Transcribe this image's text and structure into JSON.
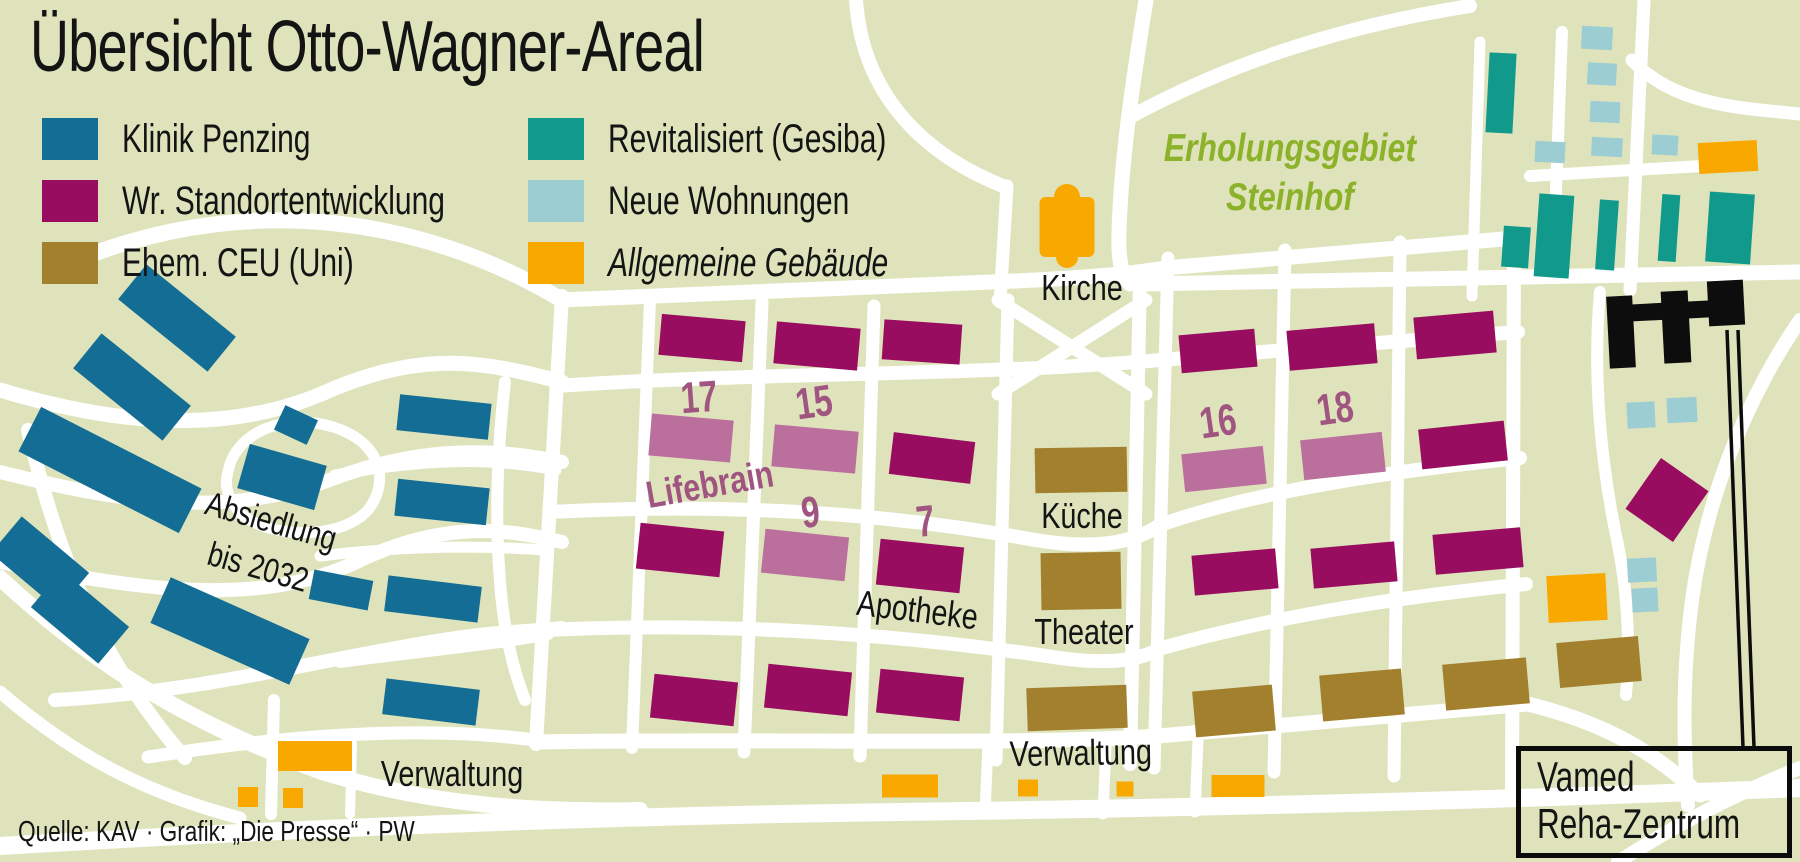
{
  "title": "Übersicht Otto-Wagner-Areal",
  "source_credit": "Quelle: KAV · Grafik: „Die Presse“ · PW",
  "colors": {
    "bg": "#dfe3bb",
    "road": "#ffffff",
    "klinik": "#146d94",
    "stand": "#990d60",
    "mauve": "#bb6f9d",
    "ceu": "#a2802e",
    "revit": "#119a8c",
    "wohn": "#9ccdd3",
    "allg": "#f9a800",
    "vamed": "#0d0d0d",
    "mauveText": "#a05581",
    "green": "#8cb22a",
    "text": "#141414"
  },
  "legend": {
    "items": [
      {
        "key": "klinik",
        "label": "Klinik Penzing",
        "italic": false
      },
      {
        "key": "stand",
        "label": "Wr. Standortentwicklung",
        "italic": false
      },
      {
        "key": "ceu",
        "label": "Ehem. CEU (Uni)",
        "italic": false
      },
      {
        "key": "revit",
        "label": "Revitalisiert (Gesiba)",
        "italic": false
      },
      {
        "key": "wohn",
        "label": "Neue Wohnungen",
        "italic": false
      },
      {
        "key": "allg",
        "label": "Allgemeine Gebäude",
        "italic": true
      }
    ]
  },
  "region_label": {
    "line1": "Erholungsgebiet",
    "line2": "Steinhof"
  },
  "vamed_label": {
    "line1": "Vamed",
    "line2": "Reha-Zentrum"
  },
  "map": {
    "roads": [
      {
        "d": "M 90,255 C 250,195 420,215 562,300",
        "w": 16
      },
      {
        "d": "M 0,390 C 140,432 245,430 335,388 C 425,352 480,360 562,382",
        "w": 15
      },
      {
        "d": "M 0,472 C 120,502 225,520 335,478 C 430,443 505,450 562,462",
        "w": 14
      },
      {
        "d": "M 0,562 C 150,592 265,608 365,558 C 445,522 505,528 562,542",
        "w": 14
      },
      {
        "d": "M 55,700 C 200,692 320,660 430,642 C 500,630 530,632 562,628",
        "w": 14
      },
      {
        "d": "M 28,430 C 55,545 95,655 185,758",
        "w": 14
      },
      {
        "d": "M 0,578 C 90,662 185,722 322,772 C 432,806 540,812 640,810",
        "w": 16
      },
      {
        "d": "M 0,692 C 70,752 140,792 240,818",
        "w": 13
      },
      {
        "d": "M 228,472 C 235,432 285,412 333,427 C 382,442 390,482 368,510 C 338,543 258,538 236,508 C 225,492 225,482 228,472",
        "w": 11
      },
      {
        "d": "M 505,382 C 497,452 495,520 500,582 C 503,622 510,662 525,700",
        "w": 12
      },
      {
        "d": "M 335,475 C 430,458 492,458 556,470",
        "w": 11
      },
      {
        "d": "M 320,556 C 400,546 472,545 545,550",
        "w": 11
      },
      {
        "d": "M 340,662 C 430,650 492,645 548,634",
        "w": 12
      },
      {
        "d": "M 148,757 C 300,733 440,725 548,742",
        "w": 13
      },
      {
        "d": "M 274,700 L 271,814",
        "w": 12
      },
      {
        "d": "M 352,744 L 350,814",
        "w": 10
      },
      {
        "d": "M 0,846 C 300,828 600,816 900,812 C 1200,808 1500,800 1800,788",
        "w": 18
      },
      {
        "d": "M 562,296 L 536,744",
        "w": 14
      },
      {
        "d": "M 650,300 L 632,748",
        "w": 12
      },
      {
        "d": "M 762,302 L 744,752",
        "w": 13
      },
      {
        "d": "M 874,306 L 860,756",
        "w": 13
      },
      {
        "d": "M 1008,300 L 996,760",
        "w": 13
      },
      {
        "d": "M 1140,278 L 1130,764",
        "w": 14
      },
      {
        "d": "M 560,300 C 760,292 920,286 1015,281 C 1100,277 1135,273 1165,268 L 1515,238",
        "w": 15
      },
      {
        "d": "M 556,386 C 760,372 980,376 1160,360 L 1518,332",
        "w": 14
      },
      {
        "d": "M 550,512 C 740,502 900,515 1035,540 C 1090,549 1130,545 1160,525 C 1260,490 1400,470 1520,458",
        "w": 14
      },
      {
        "d": "M 544,630 C 760,620 940,640 1060,658 C 1110,665 1140,660 1162,648 C 1290,612 1420,595 1526,584",
        "w": 14
      },
      {
        "d": "M 538,742 C 780,738 1000,746 1158,736 L 1528,704 C 1600,722 1650,748 1700,795",
        "w": 15
      },
      {
        "d": "M 1168,258 L 1154,768",
        "w": 13
      },
      {
        "d": "M 1285,250 L 1274,772",
        "w": 13
      },
      {
        "d": "M 1400,242 L 1394,776",
        "w": 13
      },
      {
        "d": "M 1514,236 L 1512,800",
        "w": 14
      },
      {
        "d": "M 998,394 L 1146,300",
        "w": 13
      },
      {
        "d": "M 998,300 L 1146,394",
        "w": 13
      },
      {
        "d": "M 856,0 C 862,90 918,152 1003,186",
        "w": 14
      },
      {
        "d": "M 1007,186 L 1000,302",
        "w": 13
      },
      {
        "d": "M 1146,0 C 1133,80 1121,160 1119,232 C 1118,262 1122,276 1130,284",
        "w": 15
      },
      {
        "d": "M 1128,118 C 1220,68 1330,28 1470,6",
        "w": 14
      },
      {
        "d": "M 1562,32 L 1553,272",
        "w": 12
      },
      {
        "d": "M 1644,0 C 1639,100 1635,195 1630,290",
        "w": 13
      },
      {
        "d": "M 1632,60 C 1660,90 1700,104 1760,110 L 1800,114",
        "w": 13
      },
      {
        "d": "M 1530,176 L 1702,166",
        "w": 12
      },
      {
        "d": "M 1480,42 L 1472,296",
        "w": 11
      },
      {
        "d": "M 1140,284 L 1800,272",
        "w": 15
      },
      {
        "d": "M 1600,292 C 1592,380 1602,470 1618,545 C 1628,595 1630,645 1626,695",
        "w": 12
      },
      {
        "d": "M 1800,320 C 1742,405 1705,505 1692,600 C 1684,662 1682,725 1688,805",
        "w": 14
      },
      {
        "d": "M 1618,862 C 1680,822 1740,792 1800,768",
        "w": 14
      },
      {
        "d": "M 988,742 L 985,814",
        "w": 11
      },
      {
        "d": "M 1106,744 L 1103,814",
        "w": 11
      },
      {
        "d": "M 1198,740 L 1195,812",
        "w": 11
      }
    ],
    "buildings": [
      {
        "t": "klinik",
        "x": 177,
        "y": 318,
        "w": 115,
        "h": 45,
        "r": 39
      },
      {
        "t": "klinik",
        "x": 132,
        "y": 387,
        "w": 115,
        "h": 45,
        "r": 39
      },
      {
        "t": "klinik",
        "x": 110,
        "y": 470,
        "w": 180,
        "h": 50,
        "r": 27
      },
      {
        "t": "klinik",
        "x": 296,
        "y": 425,
        "w": 36,
        "h": 27,
        "r": 25
      },
      {
        "t": "klinik",
        "x": 282,
        "y": 477,
        "w": 80,
        "h": 46,
        "r": 16
      },
      {
        "t": "klinik",
        "x": 444,
        "y": 417,
        "w": 92,
        "h": 36,
        "r": 6
      },
      {
        "t": "klinik",
        "x": 442,
        "y": 502,
        "w": 92,
        "h": 37,
        "r": 6
      },
      {
        "t": "klinik",
        "x": 40,
        "y": 563,
        "w": 88,
        "h": 48,
        "r": 40
      },
      {
        "t": "klinik",
        "x": 80,
        "y": 617,
        "w": 88,
        "h": 48,
        "r": 40
      },
      {
        "t": "klinik",
        "x": 230,
        "y": 631,
        "w": 152,
        "h": 50,
        "r": 24
      },
      {
        "t": "klinik",
        "x": 341,
        "y": 590,
        "w": 60,
        "h": 30,
        "r": 11
      },
      {
        "t": "klinik",
        "x": 433,
        "y": 599,
        "w": 94,
        "h": 36,
        "r": 7
      },
      {
        "t": "klinik",
        "x": 431,
        "y": 702,
        "w": 94,
        "h": 36,
        "r": 7
      },
      {
        "t": "stand",
        "x": 702,
        "y": 338,
        "w": 84,
        "h": 41,
        "r": 5
      },
      {
        "t": "stand",
        "x": 817,
        "y": 346,
        "w": 84,
        "h": 42,
        "r": 5
      },
      {
        "t": "stand",
        "x": 922,
        "y": 342,
        "w": 78,
        "h": 40,
        "r": 4
      },
      {
        "t": "stand",
        "x": 680,
        "y": 550,
        "w": 84,
        "h": 46,
        "r": 6
      },
      {
        "t": "stand",
        "x": 932,
        "y": 458,
        "w": 82,
        "h": 42,
        "r": 7
      },
      {
        "t": "stand",
        "x": 920,
        "y": 566,
        "w": 84,
        "h": 46,
        "r": 6
      },
      {
        "t": "stand",
        "x": 694,
        "y": 700,
        "w": 84,
        "h": 44,
        "r": 6
      },
      {
        "t": "stand",
        "x": 808,
        "y": 690,
        "w": 84,
        "h": 44,
        "r": 6
      },
      {
        "t": "stand",
        "x": 920,
        "y": 695,
        "w": 84,
        "h": 44,
        "r": 6
      },
      {
        "t": "stand",
        "x": 1218,
        "y": 351,
        "w": 76,
        "h": 38,
        "r": -5
      },
      {
        "t": "stand",
        "x": 1332,
        "y": 347,
        "w": 88,
        "h": 40,
        "r": -5
      },
      {
        "t": "stand",
        "x": 1455,
        "y": 335,
        "w": 80,
        "h": 42,
        "r": -5
      },
      {
        "t": "stand",
        "x": 1463,
        "y": 445,
        "w": 86,
        "h": 40,
        "r": -6
      },
      {
        "t": "stand",
        "x": 1235,
        "y": 572,
        "w": 84,
        "h": 40,
        "r": -5
      },
      {
        "t": "stand",
        "x": 1354,
        "y": 565,
        "w": 84,
        "h": 40,
        "r": -5
      },
      {
        "t": "stand",
        "x": 1478,
        "y": 551,
        "w": 88,
        "h": 40,
        "r": -5
      },
      {
        "t": "stand",
        "x": 1667,
        "y": 500,
        "w": 58,
        "h": 62,
        "r": 35
      },
      {
        "t": "mauve",
        "x": 691,
        "y": 438,
        "w": 82,
        "h": 42,
        "r": 5
      },
      {
        "t": "mauve",
        "x": 815,
        "y": 449,
        "w": 84,
        "h": 42,
        "r": 5
      },
      {
        "t": "mauve",
        "x": 805,
        "y": 555,
        "w": 84,
        "h": 44,
        "r": 6
      },
      {
        "t": "mauve",
        "x": 1224,
        "y": 469,
        "w": 82,
        "h": 38,
        "r": -6
      },
      {
        "t": "mauve",
        "x": 1343,
        "y": 456,
        "w": 82,
        "h": 40,
        "r": -6
      },
      {
        "t": "ceu",
        "x": 1081,
        "y": 470,
        "w": 92,
        "h": 45,
        "r": -1
      },
      {
        "t": "ceu",
        "x": 1081,
        "y": 581,
        "w": 80,
        "h": 57,
        "r": -1
      },
      {
        "t": "ceu",
        "x": 1077,
        "y": 708,
        "w": 100,
        "h": 43,
        "r": -2
      },
      {
        "t": "ceu",
        "x": 1234,
        "y": 711,
        "w": 80,
        "h": 46,
        "r": -5
      },
      {
        "t": "ceu",
        "x": 1362,
        "y": 695,
        "w": 82,
        "h": 46,
        "r": -5
      },
      {
        "t": "ceu",
        "x": 1486,
        "y": 684,
        "w": 84,
        "h": 46,
        "r": -5
      },
      {
        "t": "ceu",
        "x": 1599,
        "y": 662,
        "w": 82,
        "h": 45,
        "r": -5
      },
      {
        "t": "revit",
        "x": 1501,
        "y": 93,
        "w": 27,
        "h": 80,
        "r": 3
      },
      {
        "t": "revit",
        "x": 1554,
        "y": 236,
        "w": 35,
        "h": 83,
        "r": 4
      },
      {
        "t": "revit",
        "x": 1607,
        "y": 235,
        "w": 19,
        "h": 70,
        "r": 4
      },
      {
        "t": "revit",
        "x": 1669,
        "y": 228,
        "w": 18,
        "h": 67,
        "r": 4
      },
      {
        "t": "revit",
        "x": 1730,
        "y": 228,
        "w": 45,
        "h": 70,
        "r": 4
      },
      {
        "t": "revit",
        "x": 1516,
        "y": 247,
        "w": 27,
        "h": 41,
        "r": 4
      },
      {
        "t": "wohn",
        "x": 1597,
        "y": 38,
        "w": 31,
        "h": 23,
        "r": 3
      },
      {
        "t": "wohn",
        "x": 1602,
        "y": 74,
        "w": 29,
        "h": 22,
        "r": 3
      },
      {
        "t": "wohn",
        "x": 1605,
        "y": 112,
        "w": 30,
        "h": 21,
        "r": 3
      },
      {
        "t": "wohn",
        "x": 1607,
        "y": 147,
        "w": 31,
        "h": 19,
        "r": 3
      },
      {
        "t": "wohn",
        "x": 1550,
        "y": 152,
        "w": 30,
        "h": 21,
        "r": 3
      },
      {
        "t": "wohn",
        "x": 1665,
        "y": 145,
        "w": 26,
        "h": 20,
        "r": 3
      },
      {
        "t": "wohn",
        "x": 1641,
        "y": 415,
        "w": 28,
        "h": 26,
        "r": -3
      },
      {
        "t": "wohn",
        "x": 1682,
        "y": 410,
        "w": 30,
        "h": 25,
        "r": -3
      },
      {
        "t": "wohn",
        "x": 1642,
        "y": 570,
        "w": 29,
        "h": 24,
        "r": -3
      },
      {
        "t": "wohn",
        "x": 1645,
        "y": 600,
        "w": 26,
        "h": 24,
        "r": -3
      },
      {
        "t": "allg",
        "x": 1728,
        "y": 157,
        "w": 59,
        "h": 31,
        "r": -3
      },
      {
        "t": "allg",
        "x": 1577,
        "y": 598,
        "w": 59,
        "h": 47,
        "r": -3
      },
      {
        "t": "allg",
        "x": 315,
        "y": 756,
        "w": 74,
        "h": 30,
        "r": 0
      },
      {
        "t": "allg",
        "x": 248,
        "y": 797,
        "w": 20,
        "h": 20,
        "r": 0
      },
      {
        "t": "allg",
        "x": 293,
        "y": 798,
        "w": 20,
        "h": 20,
        "r": 0
      },
      {
        "t": "allg",
        "x": 910,
        "y": 786,
        "w": 56,
        "h": 23,
        "r": 0
      },
      {
        "t": "allg",
        "x": 1028,
        "y": 788,
        "w": 20,
        "h": 17,
        "r": 0
      },
      {
        "t": "allg",
        "x": 1125,
        "y": 789,
        "w": 17,
        "h": 15,
        "r": 0
      },
      {
        "t": "allg",
        "x": 1238,
        "y": 786,
        "w": 53,
        "h": 22,
        "r": 0
      },
      {
        "t": "vamed",
        "x": 1621,
        "y": 332,
        "w": 26,
        "h": 72,
        "r": -3
      },
      {
        "t": "vamed",
        "x": 1676,
        "y": 327,
        "w": 27,
        "h": 72,
        "r": -3
      },
      {
        "t": "vamed",
        "x": 1726,
        "y": 303,
        "w": 36,
        "h": 45,
        "r": -3
      },
      {
        "t": "vamed",
        "x": 1669,
        "y": 311,
        "w": 84,
        "h": 17,
        "r": -3
      }
    ],
    "church": {
      "x": 1067,
      "y": 227,
      "w": 55,
      "h": 60,
      "top_r": 13,
      "bottom_r": 11
    },
    "leader_lines": [
      [
        1727,
        330,
        1743,
        747
      ],
      [
        1738,
        330,
        1754,
        747
      ]
    ],
    "labels": [
      {
        "id": "kirche",
        "text": "Kirche",
        "x": 1082,
        "y": 300,
        "s": 36,
        "r": 0
      },
      {
        "id": "kueche",
        "text": "Küche",
        "x": 1082,
        "y": 528,
        "s": 36,
        "r": 0
      },
      {
        "id": "theater",
        "text": "Theater",
        "x": 1084,
        "y": 644,
        "s": 36,
        "r": 0
      },
      {
        "id": "verwaltung-mitte",
        "text": "Verwaltung",
        "x": 1081,
        "y": 765,
        "s": 36,
        "r": -1
      },
      {
        "id": "verwaltung-links",
        "text": "Verwaltung",
        "x": 452,
        "y": 786,
        "s": 36,
        "r": 0
      },
      {
        "id": "apotheke",
        "text": "Apotheke",
        "x": 916,
        "y": 622,
        "s": 36,
        "r": 7
      },
      {
        "id": "lifebrain",
        "text": "Lifebrain",
        "x": 712,
        "y": 497,
        "s": 38,
        "r": -10,
        "c": "mauveText",
        "b": 1
      },
      {
        "id": "nr-17",
        "text": "17",
        "x": 700,
        "y": 412,
        "s": 44,
        "r": -4,
        "c": "mauveText",
        "b": 1,
        "sx": 0.75
      },
      {
        "id": "nr-15",
        "text": "15",
        "x": 816,
        "y": 417,
        "s": 44,
        "r": -8,
        "c": "mauveText",
        "b": 1,
        "sx": 0.75
      },
      {
        "id": "nr-9",
        "text": "9",
        "x": 812,
        "y": 527,
        "s": 44,
        "r": -6,
        "c": "mauveText",
        "b": 1,
        "sx": 0.75
      },
      {
        "id": "nr-7",
        "text": "7",
        "x": 927,
        "y": 536,
        "s": 44,
        "r": -6,
        "c": "mauveText",
        "b": 1,
        "sx": 0.75
      },
      {
        "id": "nr-16",
        "text": "16",
        "x": 1220,
        "y": 436,
        "s": 44,
        "r": -8,
        "c": "mauveText",
        "b": 1,
        "sx": 0.75
      },
      {
        "id": "nr-18",
        "text": "18",
        "x": 1337,
        "y": 423,
        "s": 44,
        "r": -8,
        "c": "mauveText",
        "b": 1,
        "sx": 0.75
      },
      {
        "id": "absiedlung-zeile-1",
        "text": "Absiedlung",
        "x": 268,
        "y": 532,
        "s": 34,
        "r": 16
      },
      {
        "id": "absiedlung-zeile-2",
        "text": "bis 2032",
        "x": 255,
        "y": 578,
        "s": 34,
        "r": 16
      }
    ]
  }
}
